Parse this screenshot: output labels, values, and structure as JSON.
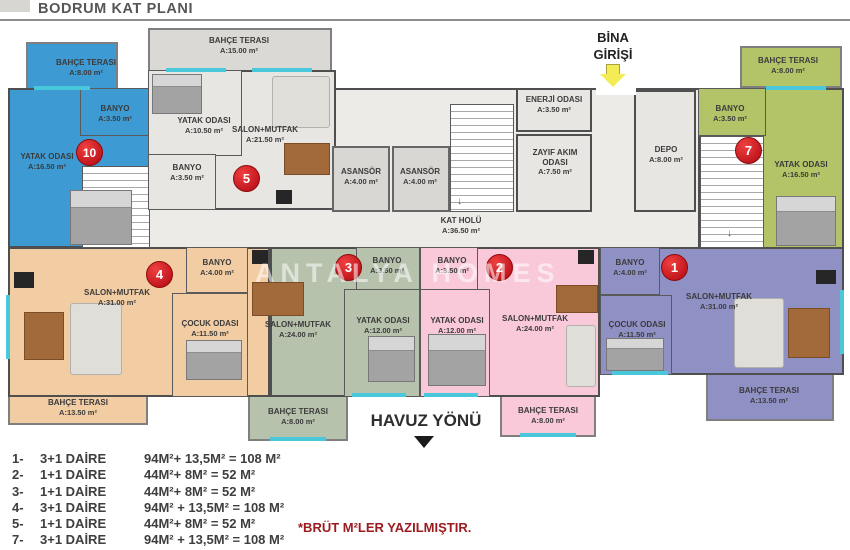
{
  "page": {
    "title": "BODRUM KAT PLANI",
    "watermark": "ANTALYA HOMES",
    "note": "*BRÜT M²LER YAZILMIŞTIR."
  },
  "directions": {
    "entrance_line1": "BİNA",
    "entrance_line2": "GİRİŞİ",
    "pool": "HAVUZ YÖNÜ"
  },
  "icons": {
    "entrance_arrow": "yellow-down-arrow ⬇",
    "pool_arrow": "black-down-arrow ▼",
    "stairs_arrow": "↓"
  },
  "colors": {
    "unit1": "#8f90c4",
    "unit2": "#f9c9d9",
    "unit3": "#b7c2ac",
    "unit4": "#f2cda4",
    "unit5": "#e8e6e2",
    "unit7": "#b3c468",
    "unit10": "#3e9ad2",
    "common_floor": "#ecebe7",
    "wall": "#4f4f4f",
    "window": "#49c8dc",
    "badge": "#b00712",
    "note_text": "#9b1c20"
  },
  "units": {
    "u1": {
      "no": "1",
      "salon": {
        "name": "SALON+MUTFAK",
        "area": "A:31.00 m²"
      },
      "banyo": {
        "name": "BANYO",
        "area": "A:4.00 m²"
      },
      "cocuk": {
        "name": "ÇOCUK ODASI",
        "area": "A:11.50 m²"
      },
      "terrace": {
        "name": "BAHÇE TERASI",
        "area": "A:13.50 m²"
      }
    },
    "u2": {
      "no": "2",
      "salon": {
        "name": "SALON+MUTFAK",
        "area": "A:24.00 m²"
      },
      "banyo": {
        "name": "BANYO",
        "area": "A:3.50 m²"
      },
      "yatak": {
        "name": "YATAK ODASI",
        "area": "A:12.00 m²"
      },
      "terrace": {
        "name": "BAHÇE TERASI",
        "area": "A:8.00 m²"
      }
    },
    "u3": {
      "no": "3",
      "salon": {
        "name": "SALON+MUTFAK",
        "area": "A:24.00 m²"
      },
      "banyo": {
        "name": "BANYO",
        "area": "A:3.50 m²"
      },
      "yatak": {
        "name": "YATAK ODASI",
        "area": "A:12.00 m²"
      },
      "terrace": {
        "name": "BAHÇE TERASI",
        "area": "A:8.00 m²"
      }
    },
    "u4": {
      "no": "4",
      "salon": {
        "name": "SALON+MUTFAK",
        "area": "A:31.00 m²"
      },
      "banyo": {
        "name": "BANYO",
        "area": "A:4.00 m²"
      },
      "cocuk": {
        "name": "ÇOCUK ODASI",
        "area": "A:11.50 m²"
      },
      "terrace": {
        "name": "BAHÇE TERASI",
        "area": "A:13.50 m²"
      }
    },
    "u5": {
      "no": "5",
      "salon": {
        "name": "SALON+MUTFAK",
        "area": "A:21.50 m²"
      },
      "banyo": {
        "name": "BANYO",
        "area": "A:3.50 m²"
      },
      "yatak": {
        "name": "YATAK ODASI",
        "area": "A:10.50 m²"
      },
      "terrace": {
        "name": "BAHÇE TERASI",
        "area": "A:15.00 m²"
      }
    },
    "u7": {
      "no": "7",
      "banyo": {
        "name": "BANYO",
        "area": "A:3.50 m²"
      },
      "yatak": {
        "name": "YATAK ODASI",
        "area": "A:16.50 m²"
      },
      "terrace": {
        "name": "BAHÇE TERASI",
        "area": "A:8.00 m²"
      }
    },
    "u10": {
      "no": "10",
      "banyo": {
        "name": "BANYO",
        "area": "A:3.50 m²"
      },
      "yatak": {
        "name": "YATAK ODASI",
        "area": "A:16.50 m²"
      },
      "terrace": {
        "name": "BAHÇE TERASI",
        "area": "A:8.00 m²"
      }
    }
  },
  "common_rooms": {
    "asansor": {
      "name": "ASANSÖR",
      "area": "A:4.00 m²"
    },
    "enerji": {
      "name": "ENERJİ ODASI",
      "area": "A:3.50 m²"
    },
    "zayif": {
      "name": "ZAYIF AKIM ODASI",
      "area": "A:7.50 m²"
    },
    "kat_holu": {
      "name": "KAT HOLÜ",
      "area": "A:36.50 m²"
    },
    "depo": {
      "name": "DEPO",
      "area": "A:8.00 m²"
    }
  },
  "legend": {
    "rows": [
      {
        "no": "1-",
        "type": "3+1 DAİRE",
        "calc": "94M²+ 13,5M² = 108 M²"
      },
      {
        "no": "2-",
        "type": "1+1 DAİRE",
        "calc": "44M²+ 8M² = 52 M²"
      },
      {
        "no": "3-",
        "type": "1+1 DAİRE",
        "calc": "44M²+ 8M² = 52 M²"
      },
      {
        "no": "4-",
        "type": "3+1 DAİRE",
        "calc": "94M² + 13,5M² = 108 M²"
      },
      {
        "no": "5-",
        "type": "1+1 DAİRE",
        "calc": "44M²+ 8M² = 52 M²"
      },
      {
        "no": "7-",
        "type": "3+1 DAİRE",
        "calc": "94M² + 13,5M² = 108 M²"
      }
    ]
  }
}
